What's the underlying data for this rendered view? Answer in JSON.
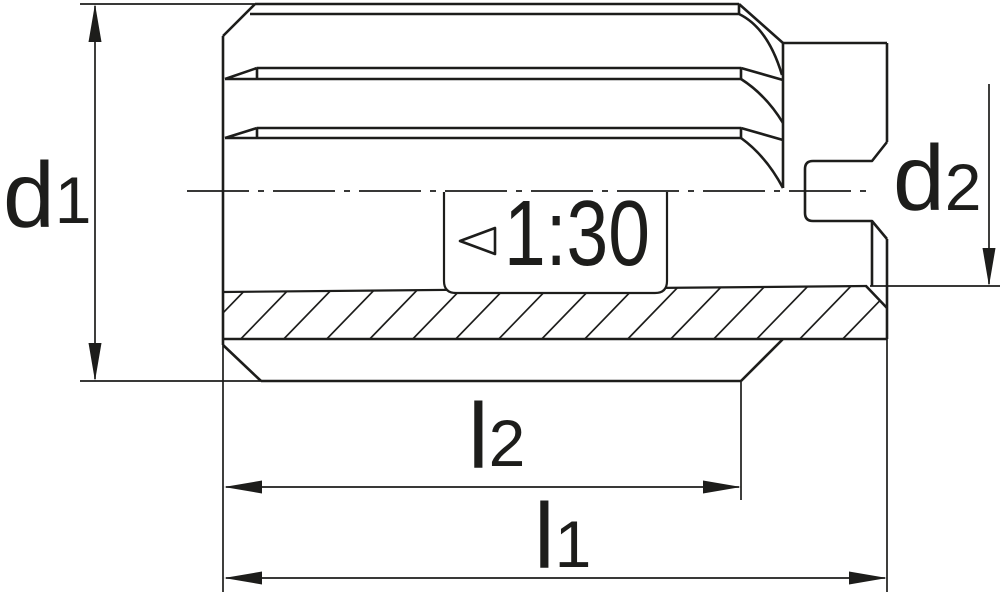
{
  "drawing": {
    "labels": {
      "d1": {
        "base": "d",
        "sub": "1"
      },
      "d2": {
        "base": "d",
        "sub": "2"
      },
      "l1": {
        "base": "l",
        "sub": "1"
      },
      "l2": {
        "base": "l",
        "sub": "2"
      },
      "taper": "1:30"
    },
    "symbols": {
      "taper_symbol": "left-pointing-open-triangle"
    },
    "colors": {
      "line": "#1d1d1b",
      "background": "#ffffff"
    },
    "dimensions": [
      {
        "name": "d1",
        "meaning": "outer diameter of fluted body",
        "orientation": "vertical",
        "side": "left"
      },
      {
        "name": "d2",
        "meaning": "bore diameter at rear end",
        "orientation": "vertical",
        "side": "right"
      },
      {
        "name": "l2",
        "meaning": "flute length",
        "orientation": "horizontal"
      },
      {
        "name": "l1",
        "meaning": "overall length",
        "orientation": "horizontal"
      },
      {
        "name": "taper",
        "value": "1:30",
        "meaning": "taper ratio of bore"
      }
    ]
  }
}
